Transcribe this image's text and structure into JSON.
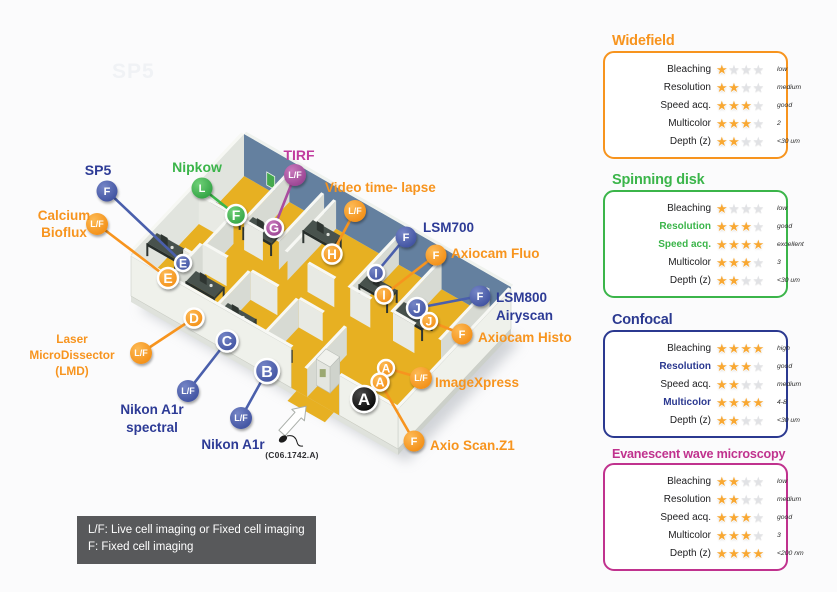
{
  "watermark": {
    "text": "SP5"
  },
  "map": {
    "credit": "(C06.1742.A)",
    "legend": {
      "line1": "L/F: Live cell imaging or Fixed cell imaging",
      "line2": "F: Fixed cell imaging"
    },
    "palette": {
      "label": {
        "orange": "#F7941E",
        "blue": "#2D3B96",
        "green": "#3BB54A",
        "purple": "#C13B9E",
        "black": "#111111"
      },
      "badge": {
        "orange": "#F7941E",
        "blue": "#4A5FAC",
        "green": "#3BB54A",
        "purple": "#A94C9F",
        "black": "#0A0A0A"
      }
    },
    "equipment": [
      {
        "name": [
          "SP5"
        ],
        "color": "blue",
        "badge": "F",
        "bx": 107,
        "by": 191,
        "tx": 183,
        "ty": 263,
        "lx": 98,
        "ly": 170,
        "align": "center",
        "fs": 14,
        "lh": 17
      },
      {
        "name": [
          "Calcium",
          "Bioflux"
        ],
        "color": "orange",
        "badge": "L/F",
        "bx": 97,
        "by": 224,
        "tx": 168,
        "ty": 278,
        "lx": 64,
        "ly": 215,
        "align": "center",
        "fs": 13.5,
        "lh": 17
      },
      {
        "name": [
          "Nipkow"
        ],
        "color": "green",
        "badge": "L",
        "bx": 202,
        "by": 188,
        "tx": 236,
        "ty": 215,
        "lx": 197,
        "ly": 167,
        "align": "center",
        "fs": 14,
        "lh": 17
      },
      {
        "name": [
          "TIRF"
        ],
        "color": "purple",
        "badge": "L/F",
        "bx": 295,
        "by": 175,
        "tx": 274,
        "ty": 228,
        "lx": 299,
        "ly": 155,
        "align": "center",
        "fs": 14,
        "lh": 17
      },
      {
        "name": [
          "Video time- lapse"
        ],
        "color": "orange",
        "badge": "L/F",
        "bx": 355,
        "by": 211,
        "tx": 332,
        "ty": 254,
        "lx": 325,
        "ly": 187,
        "align": "left",
        "fs": 13.5,
        "lh": 17
      },
      {
        "name": [
          "LSM700"
        ],
        "color": "blue",
        "badge": "F",
        "bx": 406,
        "by": 237,
        "tx": 376,
        "ty": 273,
        "lx": 423,
        "ly": 227,
        "align": "left",
        "fs": 13.5,
        "lh": 17
      },
      {
        "name": [
          "Axiocam Fluo"
        ],
        "color": "orange",
        "badge": "F",
        "bx": 436,
        "by": 255,
        "tx": 384,
        "ty": 295,
        "lx": 451,
        "ly": 253,
        "align": "left",
        "fs": 13.5,
        "lh": 17
      },
      {
        "name": [
          "LSM800",
          "Airyscan"
        ],
        "color": "blue",
        "badge": "F",
        "bx": 480,
        "by": 296,
        "tx": 417,
        "ty": 308,
        "lx": 496,
        "ly": 297,
        "align": "left",
        "fs": 13.5,
        "lh": 18
      },
      {
        "name": [
          "Axiocam Histo"
        ],
        "color": "orange",
        "badge": "F",
        "bx": 462,
        "by": 334,
        "tx": 429,
        "ty": 321,
        "lx": 478,
        "ly": 337,
        "align": "left",
        "fs": 13.5,
        "lh": 17
      },
      {
        "name": [
          "ImageXpress"
        ],
        "color": "orange",
        "badge": "L/F",
        "bx": 421,
        "by": 378,
        "tx": 386,
        "ty": 368,
        "lx": 435,
        "ly": 382,
        "align": "left",
        "fs": 13.5,
        "lh": 17
      },
      {
        "name": [
          "Axio Scan.Z1"
        ],
        "color": "orange",
        "badge": "F",
        "bx": 414,
        "by": 441,
        "tx": 380,
        "ty": 382,
        "lx": 430,
        "ly": 445,
        "align": "left",
        "fs": 13.5,
        "lh": 17
      },
      {
        "name": [
          "Laser",
          "MicroDissector",
          "(LMD)"
        ],
        "color": "orange",
        "badge": "L/F",
        "bx": 141,
        "by": 353,
        "tx": 194,
        "ty": 318,
        "lx": 72,
        "ly": 339,
        "align": "center",
        "fs": 11.8,
        "lh": 16
      },
      {
        "name": [
          "Nikon A1r",
          "spectral"
        ],
        "color": "blue",
        "badge": "L/F",
        "bx": 188,
        "by": 391,
        "tx": 227,
        "ty": 341,
        "lx": 152,
        "ly": 409,
        "align": "center",
        "fs": 13.5,
        "lh": 18
      },
      {
        "name": [
          "Nikon A1r"
        ],
        "color": "blue",
        "badge": "L/F",
        "bx": 241,
        "by": 418,
        "tx": 267,
        "ty": 371,
        "lx": 233,
        "ly": 444,
        "align": "center",
        "fs": 13.5,
        "lh": 17
      }
    ],
    "rooms": [
      {
        "letter": "E",
        "color": "blue",
        "x": 183,
        "y": 263,
        "r": 8
      },
      {
        "letter": "E",
        "color": "orange",
        "x": 168,
        "y": 278,
        "r": 10
      },
      {
        "letter": "F",
        "color": "green",
        "x": 236,
        "y": 215,
        "r": 10
      },
      {
        "letter": "G",
        "color": "purple",
        "x": 274,
        "y": 228,
        "r": 9
      },
      {
        "letter": "H",
        "color": "orange",
        "x": 332,
        "y": 254,
        "r": 9.5
      },
      {
        "letter": "I",
        "color": "blue",
        "x": 376,
        "y": 273,
        "r": 8
      },
      {
        "letter": "I",
        "color": "orange",
        "x": 384,
        "y": 295,
        "r": 8.5
      },
      {
        "letter": "J",
        "color": "blue",
        "x": 417,
        "y": 308,
        "r": 10
      },
      {
        "letter": "J",
        "color": "orange",
        "x": 429,
        "y": 321,
        "r": 8
      },
      {
        "letter": "D",
        "color": "orange",
        "x": 194,
        "y": 318,
        "r": 9.5
      },
      {
        "letter": "C",
        "color": "blue",
        "x": 227,
        "y": 341,
        "r": 10.5
      },
      {
        "letter": "B",
        "color": "blue",
        "x": 267,
        "y": 371,
        "r": 12
      },
      {
        "letter": "A",
        "color": "orange",
        "x": 386,
        "y": 368,
        "r": 8
      },
      {
        "letter": "A",
        "color": "orange",
        "x": 380,
        "y": 382,
        "r": 8.5
      },
      {
        "letter": "A",
        "color": "black",
        "x": 364,
        "y": 399,
        "r": 13
      }
    ]
  },
  "panels": [
    {
      "id": "widefield",
      "title": "Widefield",
      "color": "#F7941E",
      "rows": [
        {
          "label": "Bleaching",
          "stars": 1,
          "value": "low",
          "highlight": false
        },
        {
          "label": "Resolution",
          "stars": 2,
          "value": "medium",
          "highlight": false
        },
        {
          "label": "Speed acq.",
          "stars": 3,
          "value": "good",
          "highlight": false
        },
        {
          "label": "Multicolor",
          "stars": 3,
          "value": "2",
          "highlight": false
        },
        {
          "label": "Depth (z)",
          "stars": 2,
          "value": "<30 um",
          "highlight": false
        }
      ]
    },
    {
      "id": "spinning-disk",
      "title": "Spinning disk",
      "color": "#3BB54A",
      "rows": [
        {
          "label": "Bleaching",
          "stars": 1,
          "value": "low",
          "highlight": false
        },
        {
          "label": "Resolution",
          "stars": 3,
          "value": "good",
          "highlight": true
        },
        {
          "label": "Speed acq.",
          "stars": 4,
          "value": "excellent",
          "highlight": true
        },
        {
          "label": "Multicolor",
          "stars": 3,
          "value": "3",
          "highlight": false
        },
        {
          "label": "Depth (z)",
          "stars": 2,
          "value": "<30 um",
          "highlight": false
        }
      ]
    },
    {
      "id": "confocal",
      "title": "Confocal",
      "color": "#2B3990",
      "rows": [
        {
          "label": "Bleaching",
          "stars": 4,
          "value": "high",
          "highlight": false
        },
        {
          "label": "Resolution",
          "stars": 3,
          "value": "good",
          "highlight": true
        },
        {
          "label": "Speed acq.",
          "stars": 2,
          "value": "medium",
          "highlight": false
        },
        {
          "label": "Multicolor",
          "stars": 4,
          "value": "4-8",
          "highlight": true
        },
        {
          "label": "Depth (z)",
          "stars": 2,
          "value": "<30 um",
          "highlight": false
        }
      ]
    },
    {
      "id": "evanescent",
      "title": "Evanescent wave microscopy",
      "color": "#C0328E",
      "rows": [
        {
          "label": "Bleaching",
          "stars": 2,
          "value": "low",
          "highlight": false
        },
        {
          "label": "Resolution",
          "stars": 2,
          "value": "medium",
          "highlight": false
        },
        {
          "label": "Speed acq.",
          "stars": 3,
          "value": "good",
          "highlight": false
        },
        {
          "label": "Multicolor",
          "stars": 3,
          "value": "3",
          "highlight": false
        },
        {
          "label": "Depth (z)",
          "stars": 4,
          "value": "<200 nm",
          "highlight": false
        }
      ]
    }
  ]
}
